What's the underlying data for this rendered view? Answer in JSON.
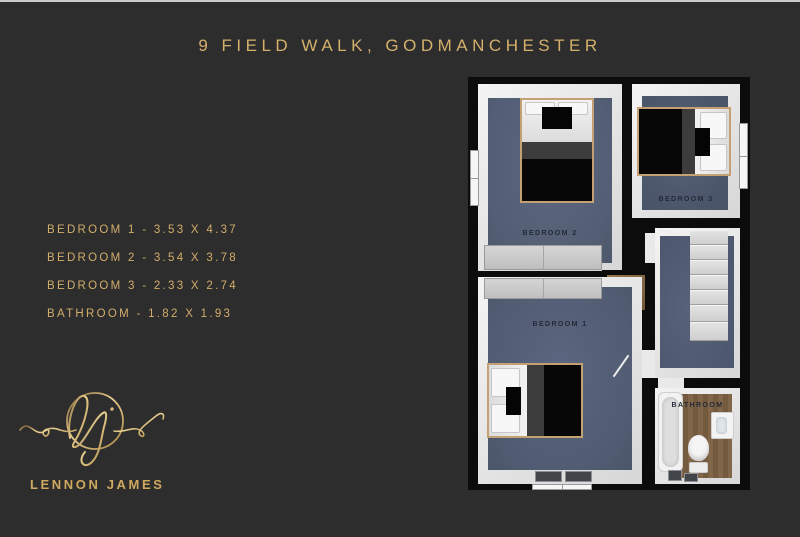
{
  "header": {
    "title": "9 FIELD WALK, GODMANCHESTER"
  },
  "room_dimensions": [
    "BEDROOM 1 - 3.53 X 4.37",
    "BEDROOM 2 - 3.54 X 3.78",
    "BEDROOM 3 - 2.33 X 2.74",
    "BATHROOM - 1.82 X 1.93"
  ],
  "floorplan": {
    "rooms": {
      "bedroom1": {
        "label": "BEDROOM 1"
      },
      "bedroom2": {
        "label": "BEDROOM 2"
      },
      "bedroom3": {
        "label": "BEDROOM 3"
      },
      "bathroom": {
        "label": "BATHROOM"
      }
    }
  },
  "brand": {
    "name": "LENNON JAMES",
    "monogram": "lj"
  },
  "colors": {
    "background": "#2d2d2d",
    "gold": "#d5b06c",
    "floor_carpet": "#56617a",
    "wall_black": "#0c0c0c",
    "wall_face": "#ebebeb",
    "bathroom_wood": "#7b6043"
  }
}
